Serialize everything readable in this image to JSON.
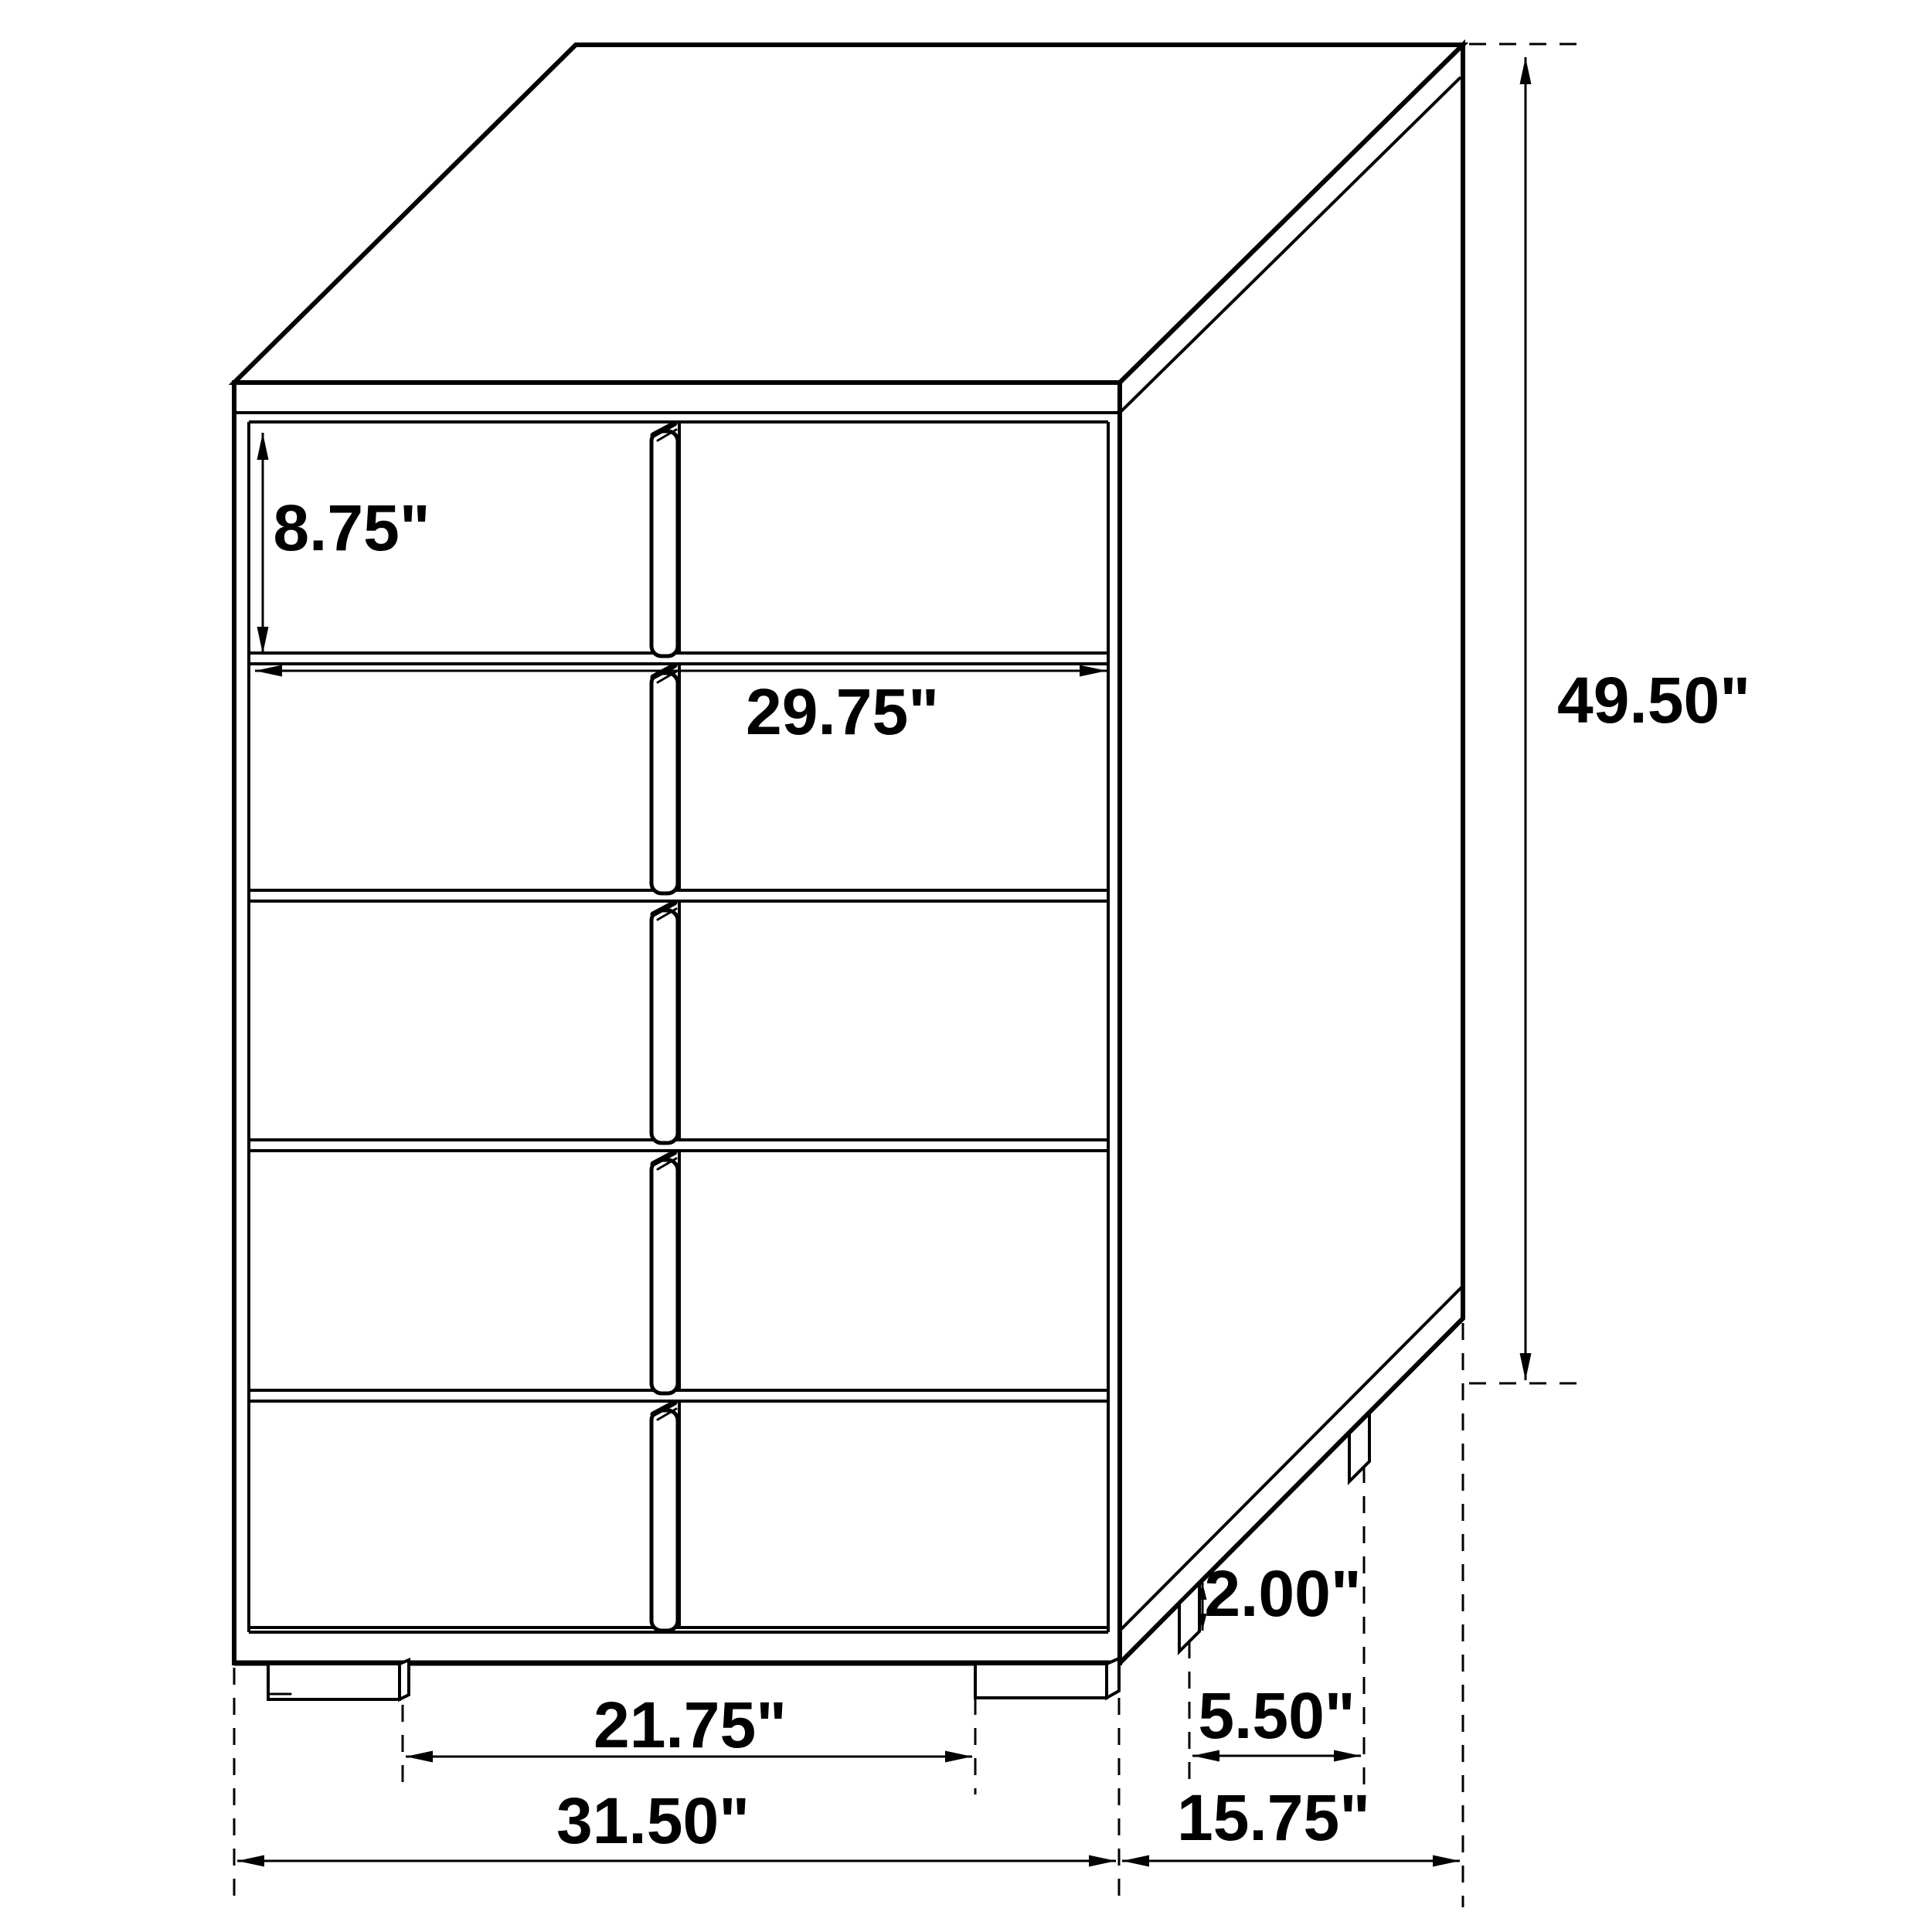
{
  "diagram": {
    "kind": "furniture dimension drawing",
    "subject": "5-drawer chest, three-quarter line view",
    "unit": "inches",
    "drawer_rows": 5,
    "colors": {
      "line": "#000000",
      "text": "#000000",
      "background": "#ffffff"
    },
    "dimensions": {
      "drawer_height": {
        "label": "8.75\"",
        "value": 8.75
      },
      "drawer_width": {
        "label": "29.75\"",
        "value": 29.75
      },
      "overall_height": {
        "label": "49.50\"",
        "value": 49.5
      },
      "leg_height": {
        "label": "2.00\"",
        "value": 2.0
      },
      "side_leg_spacing": {
        "label": "5.50\"",
        "value": 5.5
      },
      "front_leg_spacing": {
        "label": "21.75\"",
        "value": 21.75
      },
      "overall_width": {
        "label": "31.50\"",
        "value": 31.5
      },
      "overall_depth": {
        "label": "15.75\"",
        "value": 15.75
      }
    }
  }
}
